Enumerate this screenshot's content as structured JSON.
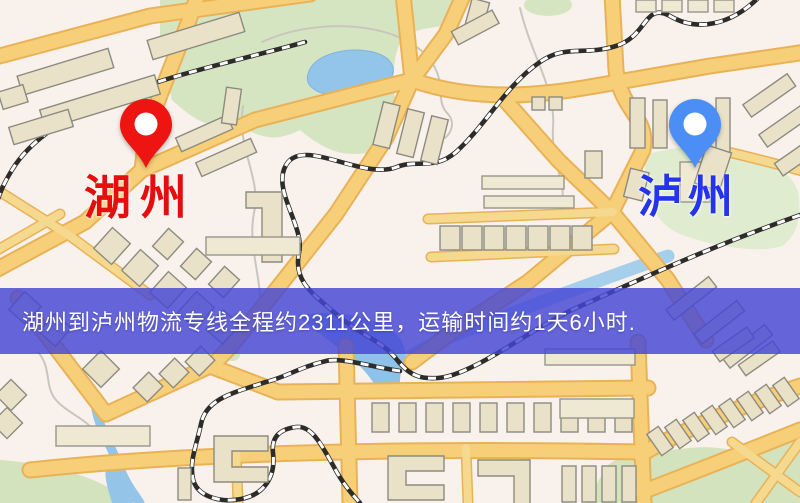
{
  "map": {
    "origin_label": "湖州",
    "destination_label": "泸州",
    "origin_label_color": "#e60d0d",
    "destination_label_color": "#2433ec",
    "origin_pin_color": "#ee1411",
    "destination_pin_color": "#4b8ef5"
  },
  "banner": {
    "text": "湖州到泸州物流专线全程约2311公里，运输时间约1天6小时.",
    "background_color": "#4446d4",
    "text_color": "#ffffff"
  },
  "palette": {
    "map_background": "#f8f1ec",
    "road_fill": "#f7cf79",
    "road_casing": "#e9b257",
    "building_fill": "#eae2c8",
    "green_area": "#d5e5c2",
    "water": "#93c5ea",
    "railway": "#2e2c2a"
  }
}
